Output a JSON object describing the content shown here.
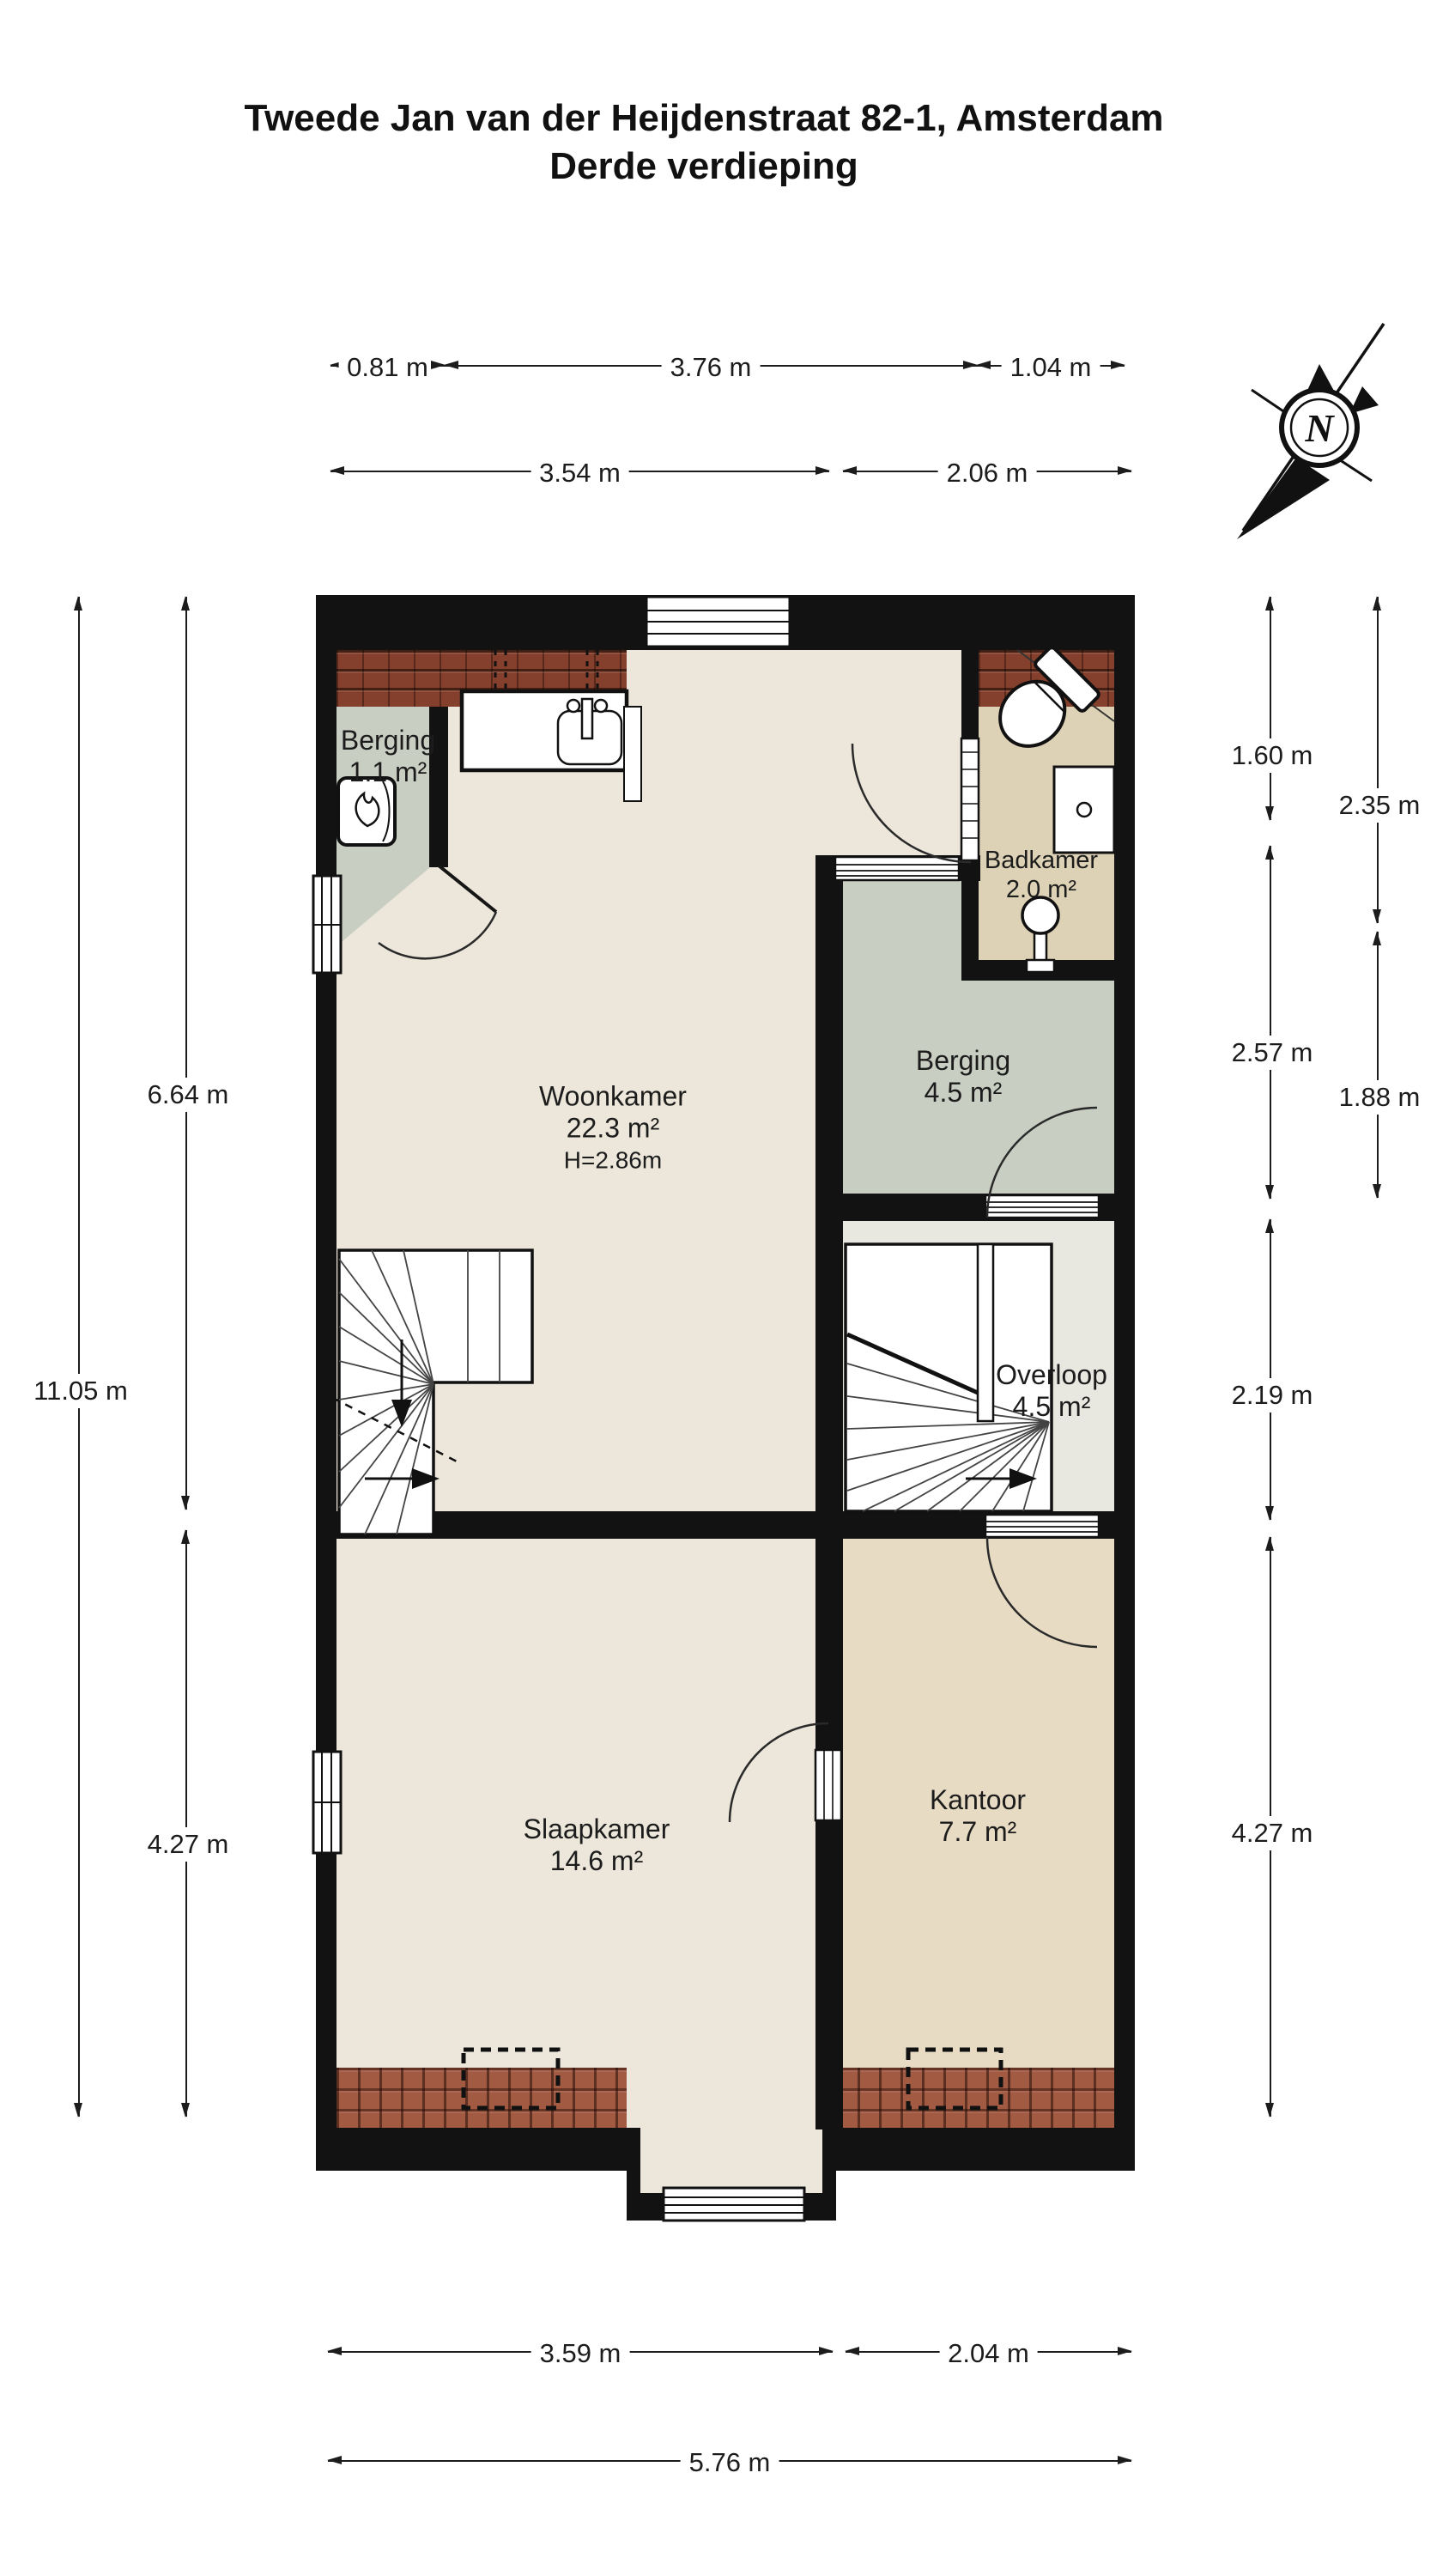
{
  "title": {
    "line1": "Tweede Jan van der Heijdenstraat 82-1, Amsterdam",
    "line2": "Derde verdieping"
  },
  "compass": {
    "label": "N"
  },
  "rooms": {
    "berging_klein": {
      "name": "Berging",
      "area": "1.1 m²"
    },
    "badkamer": {
      "name": "Badkamer",
      "area": "2.0 m²"
    },
    "woonkamer": {
      "name": "Woonkamer",
      "area": "22.3 m²",
      "ceiling": "H=2.86m"
    },
    "berging": {
      "name": "Berging",
      "area": "4.5 m²"
    },
    "overloop": {
      "name": "Overloop",
      "area": "4.5 m²"
    },
    "slaapkamer": {
      "name": "Slaapkamer",
      "area": "14.6 m²"
    },
    "kantoor": {
      "name": "Kantoor",
      "area": "7.7 m²"
    }
  },
  "dimensions": {
    "top_row1": [
      "0.81 m",
      "3.76 m",
      "1.04 m"
    ],
    "top_row2": [
      "3.54 m",
      "2.06 m"
    ],
    "left_inner": [
      "6.64 m",
      "4.27 m"
    ],
    "left_outer": [
      "11.05 m"
    ],
    "right_inner": [
      "1.60 m",
      "2.57 m",
      "2.19 m",
      "4.27 m"
    ],
    "right_outer": [
      "2.35 m",
      "1.88 m"
    ],
    "bottom_row1": [
      "3.59 m",
      "2.04 m"
    ],
    "bottom_row2": [
      "5.76 m"
    ]
  },
  "icons": {
    "compass": "compass-rose-north",
    "toilet": "toilet",
    "shower": "shower-tray",
    "sink": "pedestal-sink",
    "heater": "boiler-with-flame",
    "stairs": "winder-staircase"
  },
  "colors": {
    "wall": "#121212",
    "ink": "#1c1c1c",
    "floor": "#ece7da",
    "tan": "#ddd2b6",
    "tan2": "#e7dbc4",
    "gray": "#c9cec3",
    "hall": "#e9e8e0",
    "roofdark": "#84402c",
    "rooflight": "#a35a43",
    "white": "#ffffff"
  }
}
